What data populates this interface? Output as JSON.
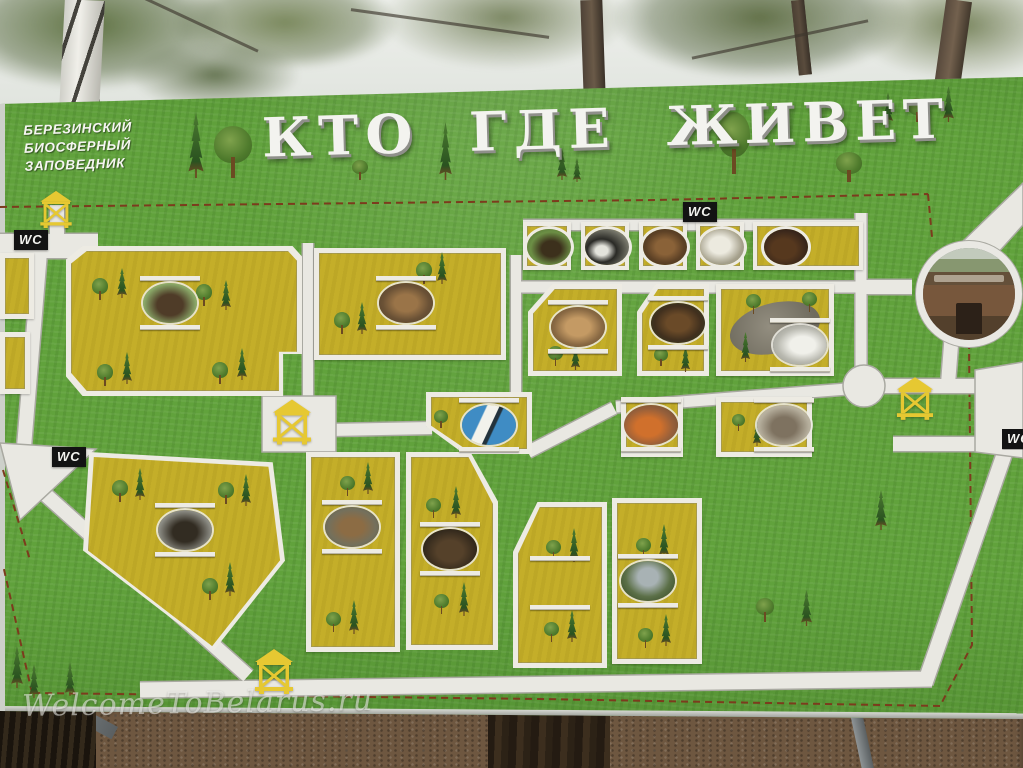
{
  "scene": {
    "description": "Photograph of a painted wooden zoo-map information board standing outdoors; birch trees and overcast white sky above, bare trampled ground and tree trunks below",
    "watermark": "WelcomeToBelarus.ru"
  },
  "board": {
    "reserve_name": {
      "line1": "БЕРЕЗИНСКИЙ",
      "line2": "БИОСФЕРНЫЙ",
      "line3": "ЗАПОВЕДНИК"
    },
    "title": "КТО ГДЕ ЖИВЕТ"
  },
  "labels": {
    "wc": "WC"
  },
  "map": {
    "type": "pictorial zoo enclosure plan with white paths on grass and yellow pens",
    "wc_sign_count": 4,
    "watchtower_count": 4,
    "entrance_photo": "round photo of wooden entrance building with signboard",
    "enclosures": [
      {
        "id": "big-left",
        "animal": "bison"
      },
      {
        "id": "upper-middle",
        "animal": "red deer"
      },
      {
        "id": "top-row-1",
        "animal": "eagle"
      },
      {
        "id": "top-row-2",
        "animal": "black stork"
      },
      {
        "id": "top-row-3",
        "animal": "brown animals"
      },
      {
        "id": "top-row-4",
        "animal": "white bird of prey"
      },
      {
        "id": "top-row-5",
        "animal": "brown bear"
      },
      {
        "id": "middle-1",
        "animal": "lynx"
      },
      {
        "id": "middle-2",
        "animal": "bear"
      },
      {
        "id": "pond",
        "animal": "swan"
      },
      {
        "id": "stork-pen",
        "animal": "white stork"
      },
      {
        "id": "small-square",
        "animal": "fox"
      },
      {
        "id": "small-wide",
        "animal": "raccoon dog"
      },
      {
        "id": "lower-left",
        "animal": "moose"
      },
      {
        "id": "lower-middle-left",
        "animal": "spotted deer"
      },
      {
        "id": "lower-middle-right",
        "animal": "wild boar"
      },
      {
        "id": "bottom-right",
        "animal": "wolf"
      },
      {
        "id": "bottom-right-empty",
        "animal": ""
      }
    ]
  },
  "colors": {
    "grass": "#61a23c",
    "pen": "#c4ae29",
    "path": "#e9e8e2",
    "pathline": "#a9a9a1",
    "dash": "#7c3b1d",
    "tower": "#e6c832",
    "wcbg": "#131313",
    "wctext": "#f2f2ee",
    "title": "#f3f3ef",
    "dirt": "#6e5740",
    "pond": "#8d887b",
    "storkblue": "#3f8cc4"
  }
}
